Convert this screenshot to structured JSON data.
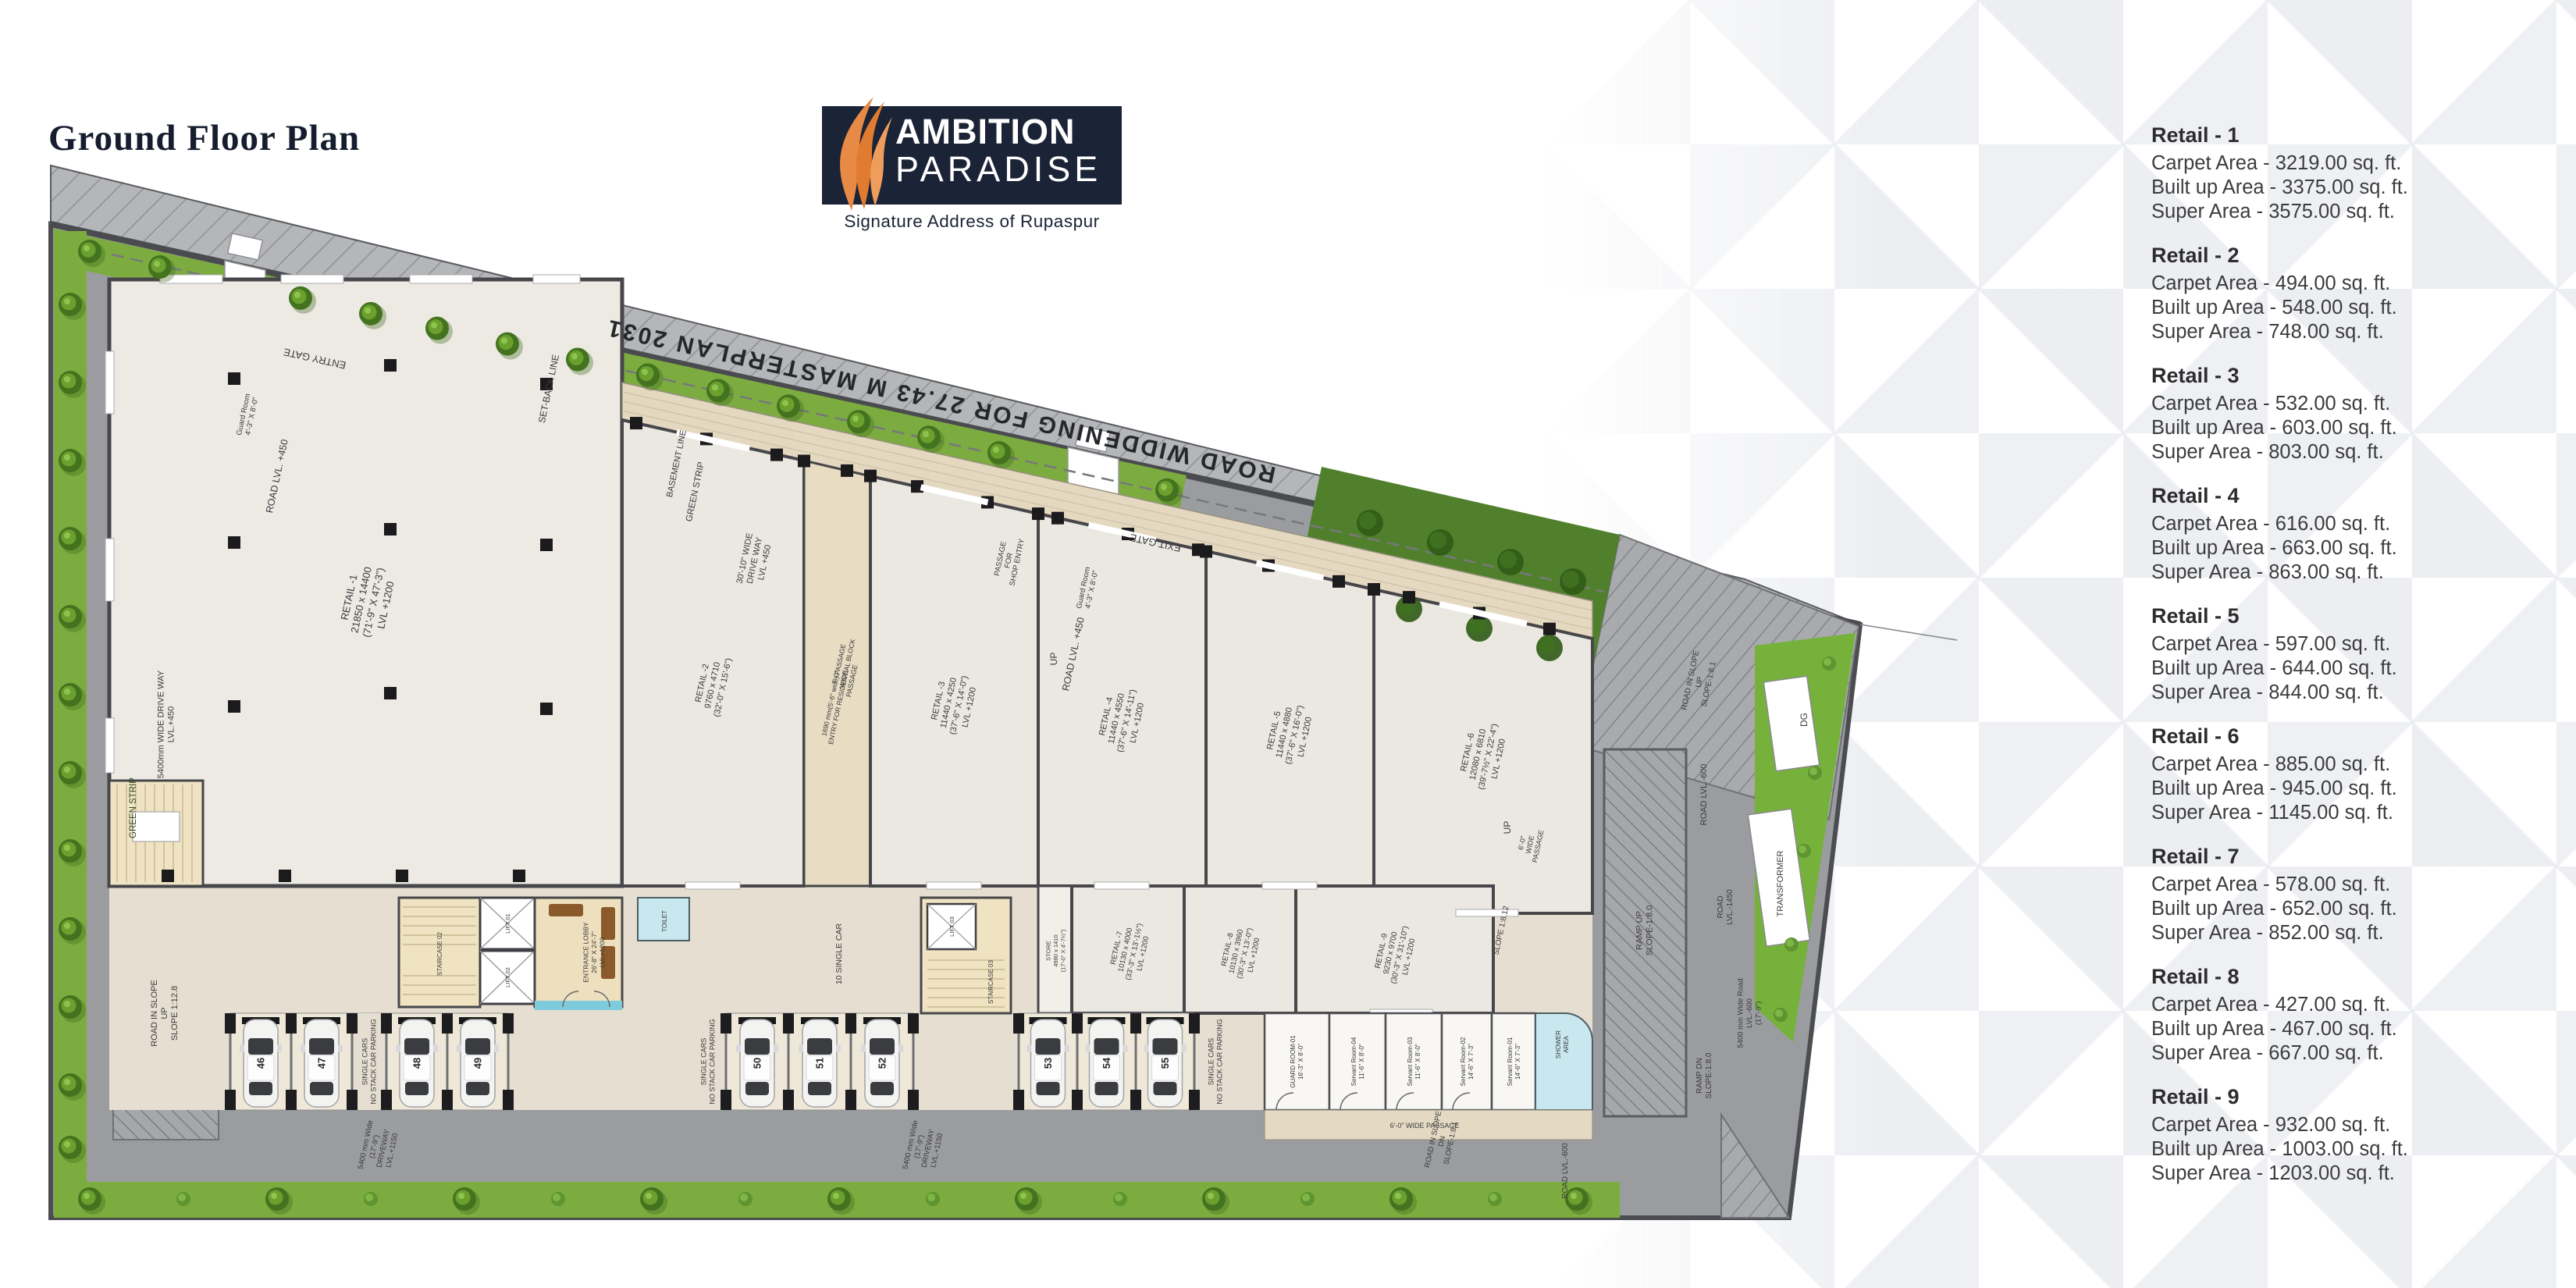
{
  "page": {
    "title": "Ground Floor Plan"
  },
  "logo": {
    "name_line1": "AMBITION",
    "name_line2": "PARADISE",
    "tagline": "Signature Address of Rupaspur"
  },
  "retail_summary": [
    {
      "name": "Retail - 1",
      "carpet_area": "Carpet Area - 3219.00 sq. ft.",
      "built_up_area": "Built up Area - 3375.00 sq. ft.",
      "super_area": "Super Area - 3575.00 sq. ft."
    },
    {
      "name": "Retail - 2",
      "carpet_area": "Carpet Area - 494.00 sq. ft.",
      "built_up_area": "Built up Area - 548.00 sq. ft.",
      "super_area": "Super Area - 748.00 sq. ft."
    },
    {
      "name": "Retail - 3",
      "carpet_area": "Carpet Area - 532.00 sq. ft.",
      "built_up_area": "Built up Area - 603.00 sq. ft.",
      "super_area": "Super Area - 803.00 sq. ft."
    },
    {
      "name": "Retail - 4",
      "carpet_area": "Carpet Area - 616.00 sq. ft.",
      "built_up_area": "Built up Area - 663.00 sq. ft.",
      "super_area": "Super Area - 863.00 sq. ft."
    },
    {
      "name": "Retail - 5",
      "carpet_area": "Carpet Area - 597.00 sq. ft.",
      "built_up_area": "Built up Area - 644.00 sq. ft.",
      "super_area": "Super Area - 844.00 sq. ft."
    },
    {
      "name": "Retail - 6",
      "carpet_area": "Carpet Area - 885.00 sq. ft.",
      "built_up_area": "Built up Area - 945.00 sq. ft.",
      "super_area": "Super Area - 1145.00 sq. ft."
    },
    {
      "name": "Retail - 7",
      "carpet_area": "Carpet Area - 578.00 sq. ft.",
      "built_up_area": "Built up Area - 652.00 sq. ft.",
      "super_area": "Super Area - 852.00 sq. ft."
    },
    {
      "name": "Retail - 8",
      "carpet_area": "Carpet Area - 427.00 sq. ft.",
      "built_up_area": "Built up Area - 467.00 sq. ft.",
      "super_area": "Super Area - 667.00 sq. ft."
    },
    {
      "name": "Retail - 9",
      "carpet_area": "Carpet Area - 932.00 sq. ft.",
      "built_up_area": "Built up Area - 1003.00 sq. ft.",
      "super_area": "Super Area - 1203.00 sq. ft."
    }
  ],
  "plan": {
    "parking_numbers": [
      "46",
      "47",
      "48",
      "49",
      "50",
      "51",
      "52",
      "53",
      "54",
      "55"
    ],
    "texts": {
      "road_widening": "ROAD WIDDENING FOR 27.43 M MASTERPLAN 2031",
      "entry_gate": "ENTRY GATE",
      "exit_gate": "EXIT GATE",
      "guard_room_a": [
        "Guard Room",
        "4'-3\" X 8'-0\""
      ],
      "guard_room_b": [
        "Guard Room",
        "4'-3\" X 8'-0\""
      ],
      "road_lvl450_a": "ROAD LVL. +450",
      "road_lvl450_b": "ROAD LVL. +450",
      "green_strip_a": "GREEN STRIP",
      "green_strip_b": "GREEN STRIP",
      "drive_way_30": [
        "30'-10\" WIDE",
        "DRIVE WAY",
        "LVL +450"
      ],
      "drive_way_5400_left": [
        "5400mm WIDE DRIVE WAY",
        "LVL.+450"
      ],
      "slope_1_12_8": [
        "ROAD IN SLOPE",
        "UP",
        "SLOPE 1:12.8"
      ],
      "setback": "SET-BACK LINE",
      "basement": "BASEMENT LINE",
      "up_a": "UP",
      "up_b": "UP",
      "passage_shop": [
        "PASSAGE",
        "FOR",
        "SHOP ENTRY"
      ],
      "passage7": [
        "7'-0\"",
        "WIDE",
        "PASSAGE"
      ],
      "passage6_a": "6'-0\" WIDE PASSAGE",
      "passage6_b": [
        "6'-0\"",
        "WIDE",
        "PASSAGE"
      ],
      "road_in_slope_up": [
        "ROAD IN SLOPE",
        "UP",
        "SLOPE-1:8.1"
      ],
      "ramp_up": [
        "RAMP UP",
        "SLOPE-1:8.0"
      ],
      "ramp_dn": [
        "RAMP DN",
        "SLOPE-1:8.0"
      ],
      "road_lvl600_a": "ROAD LVL.-600",
      "road_lvl600_b": "ROAD LVL.-600",
      "road_lvl1450": [
        "ROAD",
        "LVL.-1450"
      ],
      "wide_road5400": [
        "5400 mm Wide Road",
        "LVL.-600",
        "(17'-9\")"
      ],
      "slope_8_12": "SLOPE 1:8.12",
      "road_slope_dn": [
        "ROAD IN SLOPE",
        "DN",
        "SLOPE-1:8.1"
      ],
      "dg": "DG",
      "transformer": "TRANSFORMER",
      "driveway_a": [
        "5400 mm Wide",
        "(17'-9\")",
        "DRIVEWAY",
        "LVL.+1150"
      ],
      "driveway_b": [
        "5400 mm Wide",
        "(17'-9\")",
        "DRIVEWAY",
        "LVL.+1150"
      ],
      "single_cars_a": [
        "SINGLE CARS",
        "NO STACK CAR PARKING"
      ],
      "single_cars_b": [
        "SINGLE CARS",
        "NO STACK CAR PARKING"
      ],
      "single_cars_c": [
        "SINGLE CARS",
        "NO STACK CAR PARKING"
      ],
      "ten_single": "10 SINGLE CAR",
      "entrance_lobby": [
        "ENTRANCE LOBBY",
        "26'-8\" X 24'-7\"",
        "LVL+1200"
      ],
      "staircase02": "STAIRCASE 02",
      "staircase03": "STAIRCASE 03",
      "lift01": "LIFT 01",
      "lift02": "LIFT 02",
      "lift03": "LIFT 03",
      "guard01": [
        "GUARD ROOM-01",
        "16'-3\" X 8'-0\""
      ],
      "sr04": [
        "Servant Room-04",
        "11'-6\" X 8'-0\""
      ],
      "sr03": [
        "Servant Room-03",
        "11'-6\" X 8'-0\""
      ],
      "sr02": [
        "Servant Room-02",
        "14'-6\" X 7'-3\""
      ],
      "sr01": [
        "Servant Room-01",
        "14'-6\" X 7'-3\""
      ],
      "shower": [
        "SHOWER",
        "AREA"
      ],
      "toilet": "TOILET",
      "retail1": [
        "RETAIL -1",
        "21850 x 14400",
        "(71'-9\" X 47'-3\")",
        "LVL +1200"
      ],
      "retail2": [
        "RETAIL -2",
        "9760 x 4710",
        "(32'-0\" X 15'-6\")"
      ],
      "retail3": [
        "RETAIL -3",
        "11440 x 4250",
        "(37'-6\" X 14'-0\")",
        "LVL +1200"
      ],
      "retail4": [
        "RETAIL -4",
        "11440 x 4550",
        "(37'-6\" X 14'-11\")",
        "LVL +1200"
      ],
      "retail5": [
        "RETAIL -5",
        "11440 x 4880",
        "(37'-6\" X 16'-0\")",
        "LVL +1200"
      ],
      "retail6": [
        "RETAIL -6",
        "12080 x 6810",
        "(39'-7½\" X 22'-4\")",
        "LVL +1200"
      ],
      "retail7": [
        "RETAIL -7",
        "10130 x 4000",
        "(33'-3\" X 13'-1½\")",
        "LVL +1200"
      ],
      "retail8": [
        "RETAIL -8",
        "10130 x 3960",
        "(30'-3\" X 13'-0\")",
        "LVL +1200"
      ],
      "retail9": [
        "RETAIL -9",
        "9230 x 9700",
        "(30'-3\" X 31'-10\")",
        "LVL +1200"
      ],
      "store": [
        "STORE",
        "4980 x 1410",
        "(17'-0\" X 4'-7½\")"
      ],
      "passage_res": [
        "1690 mm(5'-6\" wide) PASSAGE",
        "ENTRY FOR RESIDENTIAL BLOCK"
      ]
    },
    "colors": {
      "site_gray": "#9b9c9f",
      "road_band": "#b5b6b9",
      "green": "#7cab3f",
      "building_floor": "#eae8e1",
      "cream": "#e5d8c1",
      "wall": "#47474b",
      "water": "#7ecbdc"
    }
  }
}
